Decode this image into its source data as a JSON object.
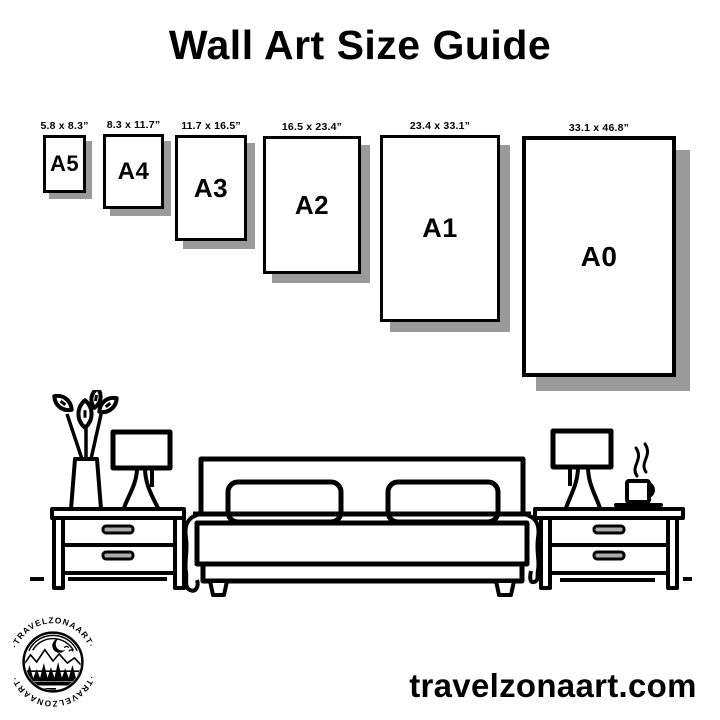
{
  "header": {
    "title": "Wall Art Size Guide"
  },
  "frames": [
    {
      "id": "A5",
      "label": "A5",
      "size": "5.8 x 8.3”"
    },
    {
      "id": "A4",
      "label": "A4",
      "size": "8.3 x 11.7”"
    },
    {
      "id": "A3",
      "label": "A3",
      "size": "11.7 x 16.5”"
    },
    {
      "id": "A2",
      "label": "A2",
      "size": "16.5 x 23.4”"
    },
    {
      "id": "A1",
      "label": "A1",
      "size": "23.4 x 33.1”"
    },
    {
      "id": "A0",
      "label": "A0",
      "size": "33.1 x 46.8”"
    }
  ],
  "logo": {
    "badge_text": "·TRAVELZONAART·"
  },
  "footer": {
    "website": "travelzonaart.com"
  },
  "scene": {
    "icons": [
      "plant-icon",
      "lamp-icon",
      "nightstand-icon",
      "bed-icon",
      "pillow-icon",
      "coffee-cup-icon",
      "steam-icon",
      "floor-line"
    ]
  },
  "colors": {
    "ink": "#000000",
    "background": "#ffffff",
    "frame_shadow": "#9a9a9a",
    "drawer_handle_fill": "#ababab"
  }
}
